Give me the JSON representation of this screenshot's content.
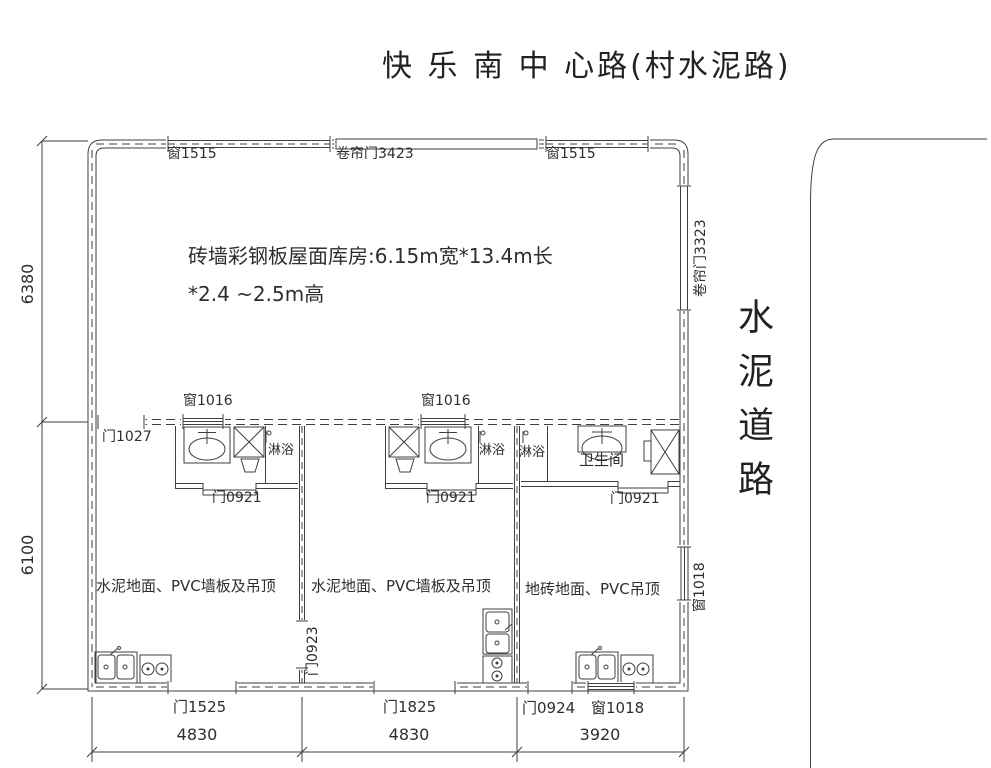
{
  "page": {
    "title": "快 乐 南 中 心路(村水泥路)"
  },
  "road": {
    "name": "水泥道路"
  },
  "warehouse": {
    "desc1": "砖墙彩钢板屋面库房:6.15m宽*13.4m长",
    "desc2": "*2.4 ~2.5m高",
    "window_left": "窗1515",
    "rolling_door_top": "卷帘门3423",
    "window_right": "窗1515",
    "rolling_door_side": "卷帘门3323"
  },
  "middle_wall": {
    "window_a": "窗1016",
    "window_b": "窗1016",
    "door": "门1027"
  },
  "bath": {
    "left_door": "门0921",
    "mid_door": "门0921",
    "right_door": "门0921",
    "shower_left": "淋浴",
    "shower_mid": "淋浴",
    "shower_right": "淋浴",
    "toilet_room": "卫生间"
  },
  "rooms": {
    "left_finish": "水泥地面、PVC墙板及吊顶",
    "mid_finish": "水泥地面、PVC墙板及吊顶",
    "right_finish": "地砖地面、PVC吊顶",
    "side_door": "门0923",
    "side_window": "窗1018"
  },
  "bottom": {
    "door_left": "门1525",
    "door_mid": "门1825",
    "door_right": "门0924",
    "window_right": "窗1018"
  },
  "dims": {
    "left_top": "6380",
    "left_bottom": "6100",
    "bottom_left": "4830",
    "bottom_mid": "4830",
    "bottom_right": "3920"
  },
  "colors": {
    "line": "#3f3f3f",
    "text": "#2e2e2e",
    "background": "#ffffff"
  }
}
